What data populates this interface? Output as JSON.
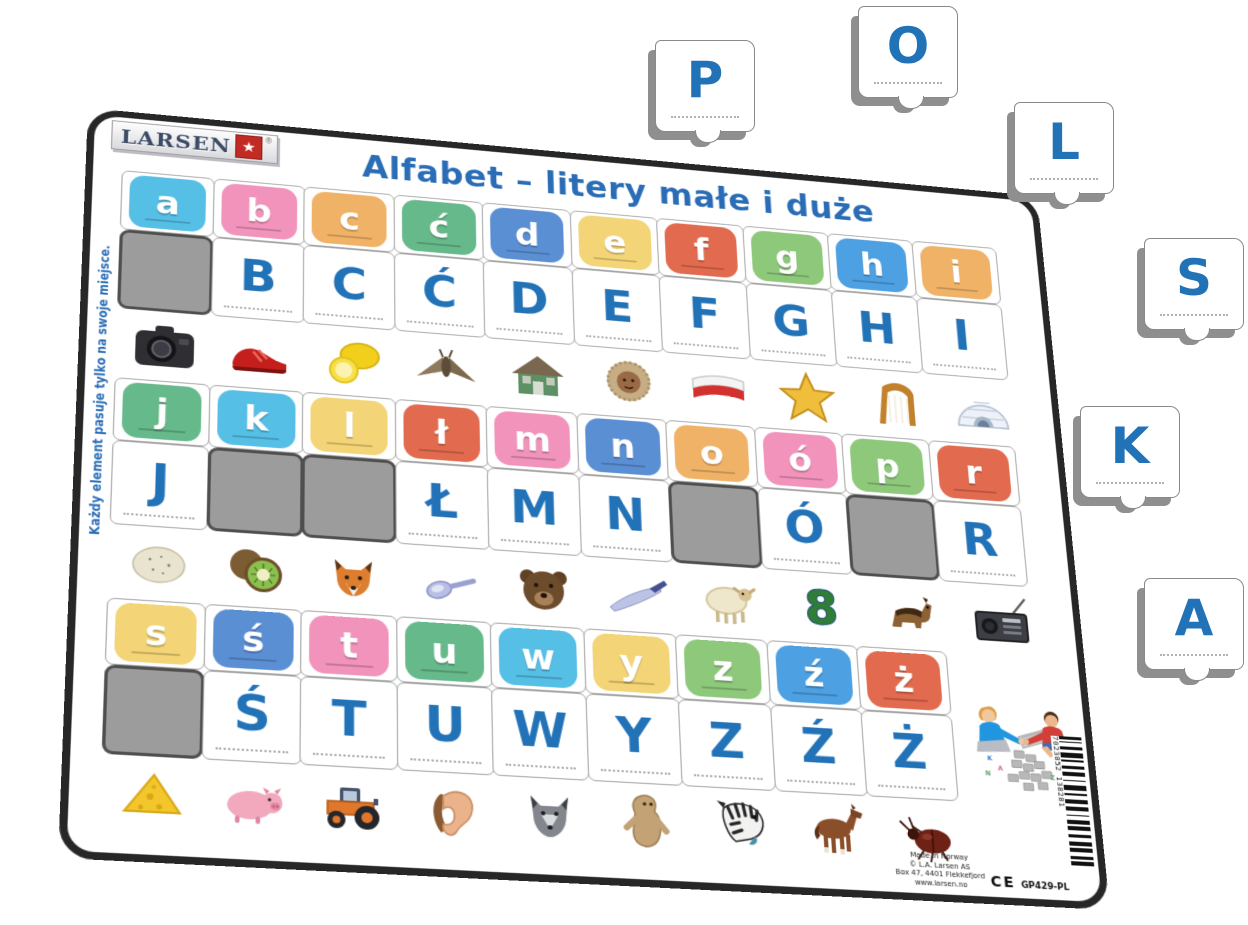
{
  "brand": {
    "logo_text": "LARSEN",
    "registered": "®"
  },
  "title": "Alfabet – litery małe i duże",
  "side_note": "Każdy element pasuje tylko na swoje miejsce.",
  "colors": {
    "letter_blue": "#2272b8",
    "title_blue": "#2a6db6",
    "empty_slot_gray": "#9c9c9c"
  },
  "sections": [
    {
      "lowercase": [
        {
          "letter": "a",
          "color": "#55bfe6"
        },
        {
          "letter": "b",
          "color": "#f193bb"
        },
        {
          "letter": "c",
          "color": "#f0b266"
        },
        {
          "letter": "ć",
          "color": "#66b98a"
        },
        {
          "letter": "d",
          "color": "#5b8fd4"
        },
        {
          "letter": "e",
          "color": "#f3d476"
        },
        {
          "letter": "f",
          "color": "#e26a4f"
        },
        {
          "letter": "g",
          "color": "#8dc87b"
        },
        {
          "letter": "h",
          "color": "#4da0e2"
        },
        {
          "letter": "i",
          "color": "#f0b266"
        }
      ],
      "uppercase": [
        {
          "letter": "",
          "missing": true
        },
        {
          "letter": "B"
        },
        {
          "letter": "C"
        },
        {
          "letter": "Ć"
        },
        {
          "letter": "D"
        },
        {
          "letter": "E"
        },
        {
          "letter": "F"
        },
        {
          "letter": "G"
        },
        {
          "letter": "H"
        },
        {
          "letter": "I"
        }
      ],
      "pictures": [
        {
          "icon": "camera"
        },
        {
          "icon": "shoe"
        },
        {
          "icon": "lemon"
        },
        {
          "icon": "moth"
        },
        {
          "icon": "house"
        },
        {
          "icon": "eskimo"
        },
        {
          "icon": "polish-flag"
        },
        {
          "icon": "star"
        },
        {
          "icon": "harp"
        },
        {
          "icon": "igloo"
        }
      ]
    },
    {
      "lowercase": [
        {
          "letter": "j",
          "color": "#66b98a"
        },
        {
          "letter": "k",
          "color": "#55bfe6"
        },
        {
          "letter": "l",
          "color": "#f3d476"
        },
        {
          "letter": "ł",
          "color": "#e26a4f"
        },
        {
          "letter": "m",
          "color": "#f193bb"
        },
        {
          "letter": "n",
          "color": "#5b8fd4"
        },
        {
          "letter": "o",
          "color": "#f0b266"
        },
        {
          "letter": "ó",
          "color": "#f193bb"
        },
        {
          "letter": "p",
          "color": "#8dc87b"
        },
        {
          "letter": "r",
          "color": "#e26a4f"
        }
      ],
      "uppercase": [
        {
          "letter": "J"
        },
        {
          "letter": "",
          "missing": true
        },
        {
          "letter": "",
          "missing": true
        },
        {
          "letter": "Ł"
        },
        {
          "letter": "M"
        },
        {
          "letter": "N"
        },
        {
          "letter": "",
          "missing": true
        },
        {
          "letter": "Ó"
        },
        {
          "letter": "",
          "missing": true
        },
        {
          "letter": "R"
        }
      ],
      "pictures": [
        {
          "icon": "egg"
        },
        {
          "icon": "kiwi"
        },
        {
          "icon": "fox"
        },
        {
          "icon": "spoon"
        },
        {
          "icon": "bear"
        },
        {
          "icon": "knife"
        },
        {
          "icon": "sheep"
        },
        {
          "icon": "number-8",
          "text": "8"
        },
        {
          "icon": "dog"
        },
        {
          "icon": "radio"
        }
      ]
    },
    {
      "lowercase": [
        {
          "letter": "s",
          "color": "#f3d476"
        },
        {
          "letter": "ś",
          "color": "#5b8fd4"
        },
        {
          "letter": "t",
          "color": "#f193bb"
        },
        {
          "letter": "u",
          "color": "#66b98a"
        },
        {
          "letter": "w",
          "color": "#55bfe6"
        },
        {
          "letter": "y",
          "color": "#f3d476"
        },
        {
          "letter": "z",
          "color": "#8dc87b"
        },
        {
          "letter": "ź",
          "color": "#4da0e2"
        },
        {
          "letter": "ż",
          "color": "#e26a4f"
        }
      ],
      "uppercase": [
        {
          "letter": "",
          "missing": true
        },
        {
          "letter": "Ś"
        },
        {
          "letter": "T"
        },
        {
          "letter": "U"
        },
        {
          "letter": "W"
        },
        {
          "letter": "Y"
        },
        {
          "letter": "Z"
        },
        {
          "letter": "Ź"
        },
        {
          "letter": "Ż"
        }
      ],
      "pictures": [
        {
          "icon": "cheese"
        },
        {
          "icon": "pig"
        },
        {
          "icon": "tractor"
        },
        {
          "icon": "ear"
        },
        {
          "icon": "wolf"
        },
        {
          "icon": "yeti"
        },
        {
          "icon": "zebra"
        },
        {
          "icon": "foal"
        },
        {
          "icon": "beetle"
        }
      ]
    }
  ],
  "loose_pieces": [
    {
      "letter": "P"
    },
    {
      "letter": "O"
    },
    {
      "letter": "L"
    },
    {
      "letter": "S"
    },
    {
      "letter": "K"
    },
    {
      "letter": "A"
    }
  ],
  "footer": {
    "made_in": "Made in Norway",
    "copyright": "© L.A. Larsen AS",
    "address": "Box 47, 4401 Flekkefjord",
    "website": "www.larsen.no",
    "ce_mark": "CE",
    "product_code": "GP429-PL",
    "barcode_number": "7023852 138281"
  }
}
